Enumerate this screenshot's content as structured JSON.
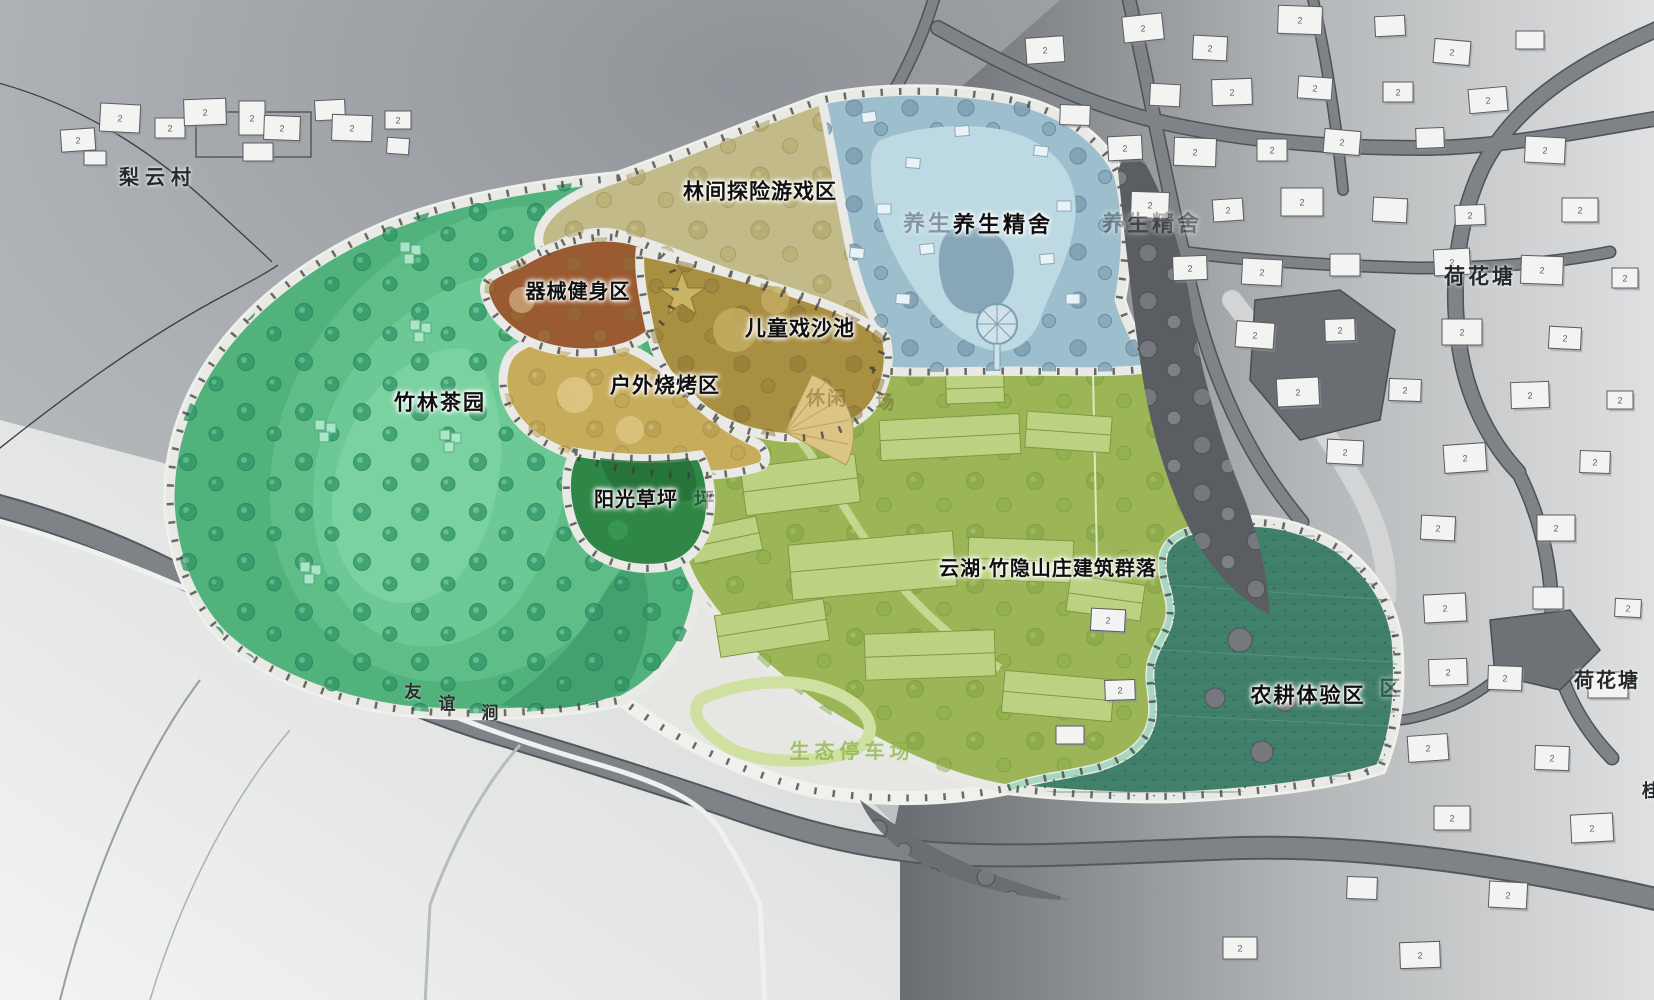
{
  "map_title_note": "landscape master plan",
  "building_floor_label": "2",
  "colors": {
    "bldg_fill": "#f3f3f2",
    "bldg_stroke": "#595d61",
    "bldg_shadow": "#90949880",
    "tea_green": "#52b27c",
    "khaki": "#c2ba88",
    "brown": "#9a5a32",
    "olive": "#a98f42",
    "sand": "#c7ac5c",
    "lawn": "#2f8747",
    "water_zone": "#9dbecd",
    "villa_green": "#9cb657",
    "farm_teal": "#41806b",
    "road": "#7e8387",
    "boundary_band": "#e9e9e5"
  },
  "zones": [
    {
      "id": "bamboo-tea-garden",
      "label": "竹林茶园",
      "color": "#52b27c"
    },
    {
      "id": "forest-adventure",
      "label": "林间探险游戏区",
      "color": "#c2ba88"
    },
    {
      "id": "equipment-fitness",
      "label": "器械健身区",
      "color": "#9a5a32"
    },
    {
      "id": "children-sand-pool",
      "label": "儿童戏沙池",
      "color": "#a98f42"
    },
    {
      "id": "outdoor-bbq",
      "label": "户外烧烤区",
      "color": "#c7ac5c"
    },
    {
      "id": "sunshine-lawn",
      "label": "阳光草坪",
      "color": "#2f8747"
    },
    {
      "id": "wellness-retreat",
      "label": "养生精舍",
      "color": "#9dbecd"
    },
    {
      "id": "villa-complex",
      "label": "云湖·竹隐山庄建筑群落",
      "color": "#9cb657"
    },
    {
      "id": "farming-experience",
      "label": "农耕体验区",
      "color": "#41806b"
    },
    {
      "id": "leisure-plaza",
      "label": "休闲广场",
      "color": "#dcc584"
    },
    {
      "id": "eco-parking",
      "label": "生态停车场",
      "color": "#cfe0a0"
    }
  ],
  "labels": [
    {
      "name": "label-bamboo-tea-garden",
      "text": "竹林茶园",
      "x": 440,
      "y": 403,
      "size": 21,
      "ls": 2,
      "style": "zone"
    },
    {
      "name": "label-forest-adventure",
      "text": "林间探险游戏区",
      "x": 760,
      "y": 192,
      "size": 21,
      "ls": 1,
      "style": "zone"
    },
    {
      "name": "label-equipment-fitness",
      "text": "器械健身区",
      "x": 578,
      "y": 292,
      "size": 20,
      "ls": 1,
      "style": "zone"
    },
    {
      "name": "label-children-sand-pool",
      "text": "儿童戏沙池",
      "x": 800,
      "y": 329,
      "size": 21,
      "ls": 1,
      "style": "zone"
    },
    {
      "name": "label-outdoor-bbq",
      "text": "户外烧烤区",
      "x": 665,
      "y": 386,
      "size": 21,
      "ls": 1,
      "style": "zone"
    },
    {
      "name": "label-sunshine-lawn",
      "text": "阳光草坪",
      "x": 636,
      "y": 500,
      "size": 20,
      "ls": 1,
      "style": "zone"
    },
    {
      "name": "label-wellness-retreat",
      "text": "养生精舍",
      "x": 1003,
      "y": 225,
      "size": 22,
      "ls": 3,
      "style": "zone"
    },
    {
      "name": "label-villa-complex",
      "text": "云湖·竹隐山庄建筑群落",
      "x": 1048,
      "y": 569,
      "size": 20,
      "ls": 1,
      "style": "zone"
    },
    {
      "name": "label-farming-experience",
      "text": "农耕体验区",
      "x": 1308,
      "y": 696,
      "size": 21,
      "ls": 2,
      "style": "zone"
    },
    {
      "name": "label-ghost-wellness-1",
      "text": "养生",
      "x": 928,
      "y": 224,
      "size": 22,
      "ls": 3,
      "style": "zone style-ghost"
    },
    {
      "name": "label-ghost-wellness-2",
      "text": "养生精舍",
      "x": 1152,
      "y": 224,
      "size": 22,
      "ls": 3,
      "style": "zone style-ghost"
    },
    {
      "name": "label-ghost-lawn",
      "text": "坪",
      "x": 704,
      "y": 501,
      "size": 20,
      "ls": 0,
      "style": "zone style-ghost"
    },
    {
      "name": "label-ghost-farming",
      "text": "区",
      "x": 1390,
      "y": 689,
      "size": 21,
      "ls": 0,
      "style": "zone style-ghost"
    },
    {
      "name": "label-liyun-village",
      "text": "梨云村",
      "x": 158,
      "y": 178,
      "size": 20,
      "ls": 6,
      "style": "village"
    },
    {
      "name": "label-lotus-pond-top",
      "text": "荷花塘",
      "x": 1480,
      "y": 277,
      "size": 21,
      "ls": 3,
      "style": "village"
    },
    {
      "name": "label-lotus-pond-right",
      "text": "荷花塘",
      "x": 1607,
      "y": 681,
      "size": 20,
      "ls": 2,
      "style": "village"
    },
    {
      "name": "label-edge-partial",
      "text": "桂",
      "x": 1651,
      "y": 791,
      "size": 18,
      "ls": 0,
      "style": "village"
    },
    {
      "name": "label-stream-char-1",
      "text": "友",
      "x": 413,
      "y": 692,
      "size": 17,
      "ls": 0,
      "style": "stream"
    },
    {
      "name": "label-stream-char-2",
      "text": "谊",
      "x": 447,
      "y": 704,
      "size": 17,
      "ls": 0,
      "style": "stream"
    },
    {
      "name": "label-stream-char-3",
      "text": "涧",
      "x": 490,
      "y": 713,
      "size": 17,
      "ls": 0,
      "style": "stream"
    },
    {
      "name": "label-wm-leisure-1",
      "text": "休闲",
      "x": 827,
      "y": 399,
      "size": 19,
      "ls": 2,
      "style": "wm-tan"
    },
    {
      "name": "label-wm-leisure-2",
      "text": "场",
      "x": 885,
      "y": 403,
      "size": 19,
      "ls": 0,
      "style": "wm-tan"
    },
    {
      "name": "label-wm-parking",
      "text": "生态停车场",
      "x": 852,
      "y": 752,
      "size": 20,
      "ls": 5,
      "style": "wm-green"
    }
  ],
  "buildings": {
    "floor_label": "2",
    "items": [
      [
        78,
        140,
        34,
        22,
        -4,
        1
      ],
      [
        120,
        118,
        40,
        28,
        3,
        1
      ],
      [
        170,
        128,
        30,
        20,
        0,
        1
      ],
      [
        205,
        112,
        42,
        26,
        -2,
        1
      ],
      [
        252,
        118,
        26,
        34,
        0,
        1
      ],
      [
        282,
        128,
        36,
        24,
        2,
        1
      ],
      [
        330,
        110,
        30,
        20,
        -3,
        0
      ],
      [
        352,
        128,
        40,
        26,
        2,
        1
      ],
      [
        398,
        120,
        26,
        18,
        0,
        1
      ],
      [
        258,
        152,
        30,
        18,
        0,
        0
      ],
      [
        398,
        146,
        22,
        16,
        4,
        0
      ],
      [
        95,
        158,
        22,
        14,
        0,
        0
      ],
      [
        1143,
        28,
        40,
        26,
        -6,
        1
      ],
      [
        1210,
        48,
        34,
        24,
        3,
        1
      ],
      [
        1300,
        20,
        44,
        28,
        2,
        1
      ],
      [
        1390,
        26,
        30,
        20,
        -3,
        0
      ],
      [
        1452,
        52,
        36,
        24,
        5,
        1
      ],
      [
        1530,
        40,
        28,
        18,
        0,
        0
      ],
      [
        1165,
        95,
        30,
        22,
        3,
        0
      ],
      [
        1232,
        92,
        40,
        26,
        -2,
        1
      ],
      [
        1315,
        88,
        34,
        22,
        4,
        1
      ],
      [
        1398,
        92,
        30,
        20,
        0,
        1
      ],
      [
        1488,
        100,
        38,
        24,
        -5,
        1
      ],
      [
        1125,
        148,
        34,
        24,
        -3,
        1
      ],
      [
        1195,
        152,
        42,
        28,
        2,
        1
      ],
      [
        1272,
        150,
        30,
        22,
        0,
        1
      ],
      [
        1342,
        142,
        36,
        24,
        5,
        1
      ],
      [
        1430,
        138,
        28,
        20,
        -2,
        0
      ],
      [
        1545,
        150,
        40,
        26,
        3,
        1
      ],
      [
        1150,
        205,
        38,
        26,
        2,
        1
      ],
      [
        1228,
        210,
        30,
        22,
        -4,
        1
      ],
      [
        1302,
        202,
        42,
        28,
        0,
        1
      ],
      [
        1390,
        210,
        34,
        24,
        3,
        0
      ],
      [
        1470,
        215,
        30,
        20,
        -2,
        1
      ],
      [
        1580,
        210,
        36,
        24,
        0,
        1
      ],
      [
        1190,
        268,
        34,
        24,
        -2,
        1
      ],
      [
        1262,
        272,
        40,
        26,
        3,
        1
      ],
      [
        1345,
        265,
        30,
        22,
        0,
        0
      ],
      [
        1452,
        262,
        36,
        26,
        -3,
        1
      ],
      [
        1542,
        270,
        42,
        28,
        2,
        1
      ],
      [
        1625,
        278,
        26,
        20,
        0,
        1
      ],
      [
        1255,
        335,
        38,
        26,
        4,
        1
      ],
      [
        1340,
        330,
        30,
        22,
        -2,
        1
      ],
      [
        1462,
        332,
        40,
        26,
        0,
        1
      ],
      [
        1565,
        338,
        32,
        22,
        3,
        1
      ],
      [
        1298,
        392,
        42,
        28,
        -3,
        1
      ],
      [
        1405,
        390,
        32,
        22,
        2,
        1
      ],
      [
        1530,
        395,
        38,
        26,
        -2,
        1
      ],
      [
        1620,
        400,
        26,
        18,
        0,
        1
      ],
      [
        1345,
        452,
        36,
        24,
        3,
        1
      ],
      [
        1465,
        458,
        42,
        28,
        -4,
        1
      ],
      [
        1595,
        462,
        30,
        22,
        2,
        1
      ],
      [
        1438,
        528,
        34,
        24,
        3,
        1
      ],
      [
        1556,
        528,
        38,
        26,
        0,
        1
      ],
      [
        1445,
        608,
        42,
        28,
        -3,
        1
      ],
      [
        1548,
        598,
        30,
        22,
        0,
        0
      ],
      [
        1628,
        608,
        26,
        18,
        3,
        1
      ],
      [
        1448,
        672,
        38,
        26,
        -2,
        1
      ],
      [
        1505,
        678,
        34,
        24,
        2,
        1
      ],
      [
        1608,
        685,
        40,
        26,
        0,
        1
      ],
      [
        1428,
        748,
        40,
        26,
        -4,
        1
      ],
      [
        1552,
        758,
        34,
        24,
        2,
        1
      ],
      [
        1452,
        818,
        36,
        24,
        0,
        1
      ],
      [
        1592,
        828,
        42,
        28,
        -3,
        1
      ],
      [
        1362,
        888,
        30,
        22,
        2,
        0
      ],
      [
        1508,
        895,
        38,
        26,
        3,
        1
      ],
      [
        1240,
        948,
        34,
        22,
        0,
        1
      ],
      [
        1420,
        955,
        40,
        26,
        -2,
        1
      ],
      [
        1045,
        50,
        38,
        26,
        -4,
        1
      ],
      [
        1075,
        115,
        30,
        20,
        2,
        0
      ],
      [
        1108,
        620,
        34,
        22,
        3,
        1
      ],
      [
        1120,
        690,
        30,
        20,
        -2,
        1
      ],
      [
        1070,
        735,
        28,
        18,
        0,
        0
      ]
    ]
  }
}
